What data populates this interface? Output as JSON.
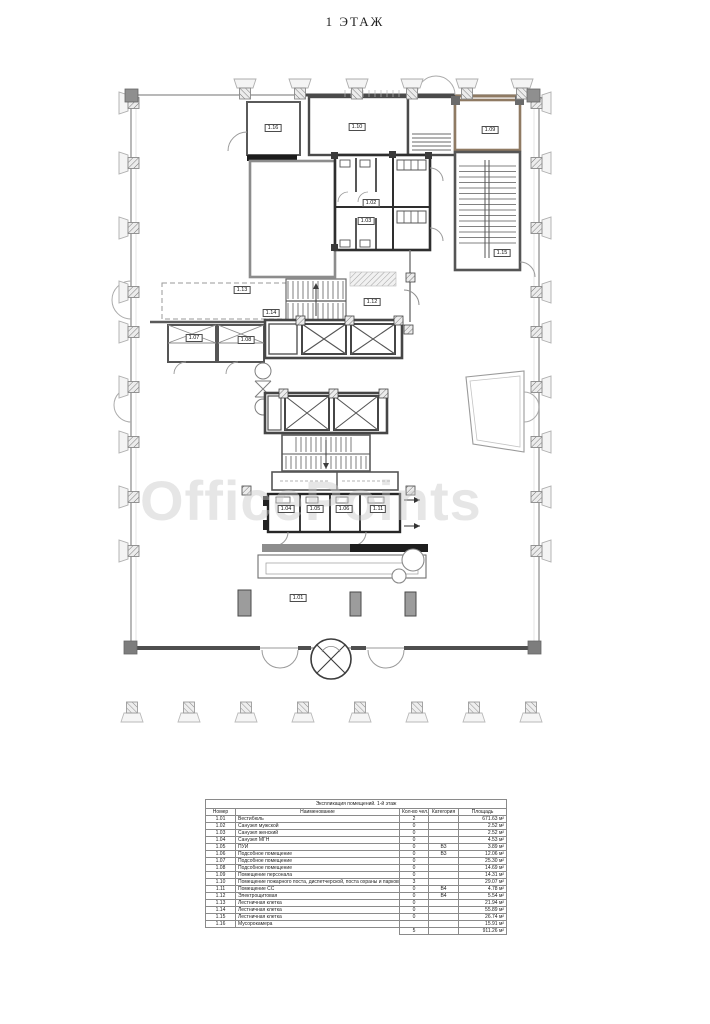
{
  "page": {
    "title": "1 ЭТАЖ",
    "watermark": "OfficePoints"
  },
  "plan": {
    "labels": [
      {
        "text": "1.16",
        "x": 273,
        "y": 128
      },
      {
        "text": "1.10",
        "x": 357,
        "y": 127
      },
      {
        "text": "1.09",
        "x": 490,
        "y": 130
      },
      {
        "text": "1.02",
        "x": 371,
        "y": 203
      },
      {
        "text": "1.03",
        "x": 366,
        "y": 221
      },
      {
        "text": "1.15",
        "x": 502,
        "y": 253
      },
      {
        "text": "1.13",
        "x": 242,
        "y": 290
      },
      {
        "text": "1.12",
        "x": 372,
        "y": 302
      },
      {
        "text": "1.14",
        "x": 271,
        "y": 313
      },
      {
        "text": "1.07",
        "x": 194,
        "y": 338
      },
      {
        "text": "1.08",
        "x": 246,
        "y": 340
      },
      {
        "text": "1.04",
        "x": 286,
        "y": 509
      },
      {
        "text": "1.05",
        "x": 315,
        "y": 509
      },
      {
        "text": "1.06",
        "x": 344,
        "y": 509
      },
      {
        "text": "1.11",
        "x": 378,
        "y": 509
      },
      {
        "text": "1.01",
        "x": 298,
        "y": 598
      }
    ]
  },
  "table": {
    "title": "Экспликация помещений. 1-й этаж",
    "columns": [
      "Номер",
      "Наименование",
      "Кол-во чел.",
      "Категория",
      "Площадь"
    ],
    "rows": [
      [
        "1.01",
        "Вестибюль",
        "2",
        "",
        "671.63 м²"
      ],
      [
        "1.02",
        "Санузел мужской",
        "0",
        "",
        "2.52 м²"
      ],
      [
        "1.03",
        "Санузел женский",
        "0",
        "",
        "2.52 м²"
      ],
      [
        "1.04",
        "Санузел МГН",
        "0",
        "",
        "4.53 м²"
      ],
      [
        "1.05",
        "ПУИ",
        "0",
        "В3",
        "3.89 м²"
      ],
      [
        "1.06",
        "Подсобное помещение",
        "0",
        "В3",
        "12.06 м²"
      ],
      [
        "1.07",
        "Подсобное помещение",
        "0",
        "",
        "25.30 м²"
      ],
      [
        "1.08",
        "Подсобное помещение",
        "0",
        "",
        "14.69 м²"
      ],
      [
        "1.09",
        "Помещение персонала",
        "0",
        "",
        "14.31 м²"
      ],
      [
        "1.10",
        "Помещение пожарного поста, диспетчерской, поста охраны и парковщика",
        "3",
        "",
        "29.07 м²"
      ],
      [
        "1.11",
        "Помещение СС",
        "0",
        "В4",
        "4.78 м²"
      ],
      [
        "1.12",
        "Электрощитовая",
        "0",
        "В4",
        "5.54 м²"
      ],
      [
        "1.13",
        "Лестничная клетка",
        "0",
        "",
        "21.94 м²"
      ],
      [
        "1.14",
        "Лестничная клетка",
        "0",
        "",
        "55.89 м²"
      ],
      [
        "1.15",
        "Лестничная клетка",
        "0",
        "",
        "26.74 м²"
      ],
      [
        "1.16",
        "Мусорокамера",
        "",
        "",
        "15.91 м²"
      ]
    ],
    "total": {
      "people": "5",
      "category": "",
      "area": "911.26 м²"
    }
  }
}
